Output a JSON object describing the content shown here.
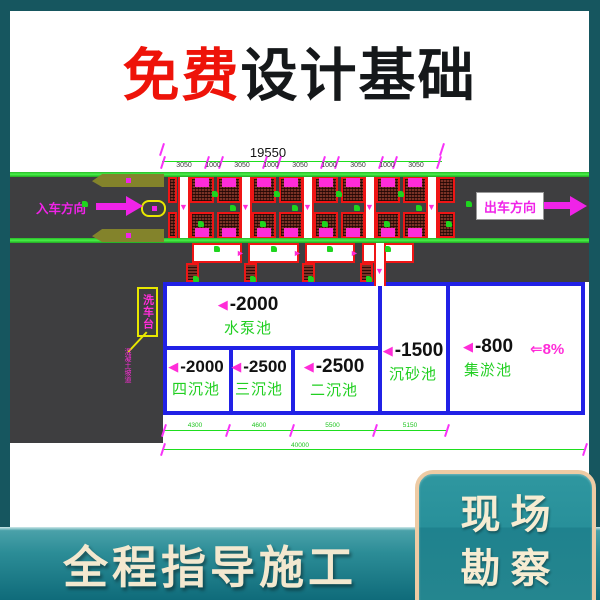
{
  "header": {
    "title_red": "免费",
    "title_dark": "设计基础"
  },
  "banner": {
    "text": "全程指导施工"
  },
  "corner_box": {
    "line1": "现场",
    "line2": "勘察"
  },
  "drawing": {
    "top_dim": {
      "total": "19550",
      "segments": [
        "3050",
        "1000",
        "3050",
        "1000",
        "3050",
        "1000",
        "3050",
        "1000",
        "3050"
      ]
    },
    "bottom_dim": {
      "segments": [
        "4300",
        "4600",
        "5500",
        "5150"
      ],
      "total": "40000"
    },
    "entry_label": "入车方向",
    "exit_label": "出车方向",
    "slope_label": "⇐8%",
    "depth_marker": "◀",
    "callout": {
      "box_label": "洗车台",
      "leader_label": "混凝土坡道"
    },
    "pools": [
      {
        "depth": "-2000",
        "name": "水泵池"
      },
      {
        "depth": "-2000",
        "name": "四沉池"
      },
      {
        "depth": "-2500",
        "name": "三沉池"
      },
      {
        "depth": "-2500",
        "name": "二沉池"
      },
      {
        "depth": "-1500",
        "name": "沉砂池"
      },
      {
        "depth": "-800",
        "name": "集淤池"
      }
    ]
  },
  "colors": {
    "page_teal": "#16565f",
    "title_red": "#ee1309",
    "title_dark": "#15181a",
    "road_gray": "#3e3e40",
    "cad_green": "#1ed51e",
    "cad_magenta": "#ff2cd8",
    "cad_red": "#ef1515",
    "cad_blue": "#2121e6",
    "cad_yellow": "#e8e800",
    "banner_teal": "#2c8d97",
    "cream": "#f3e8cf",
    "border_cream": "#eecba4"
  }
}
